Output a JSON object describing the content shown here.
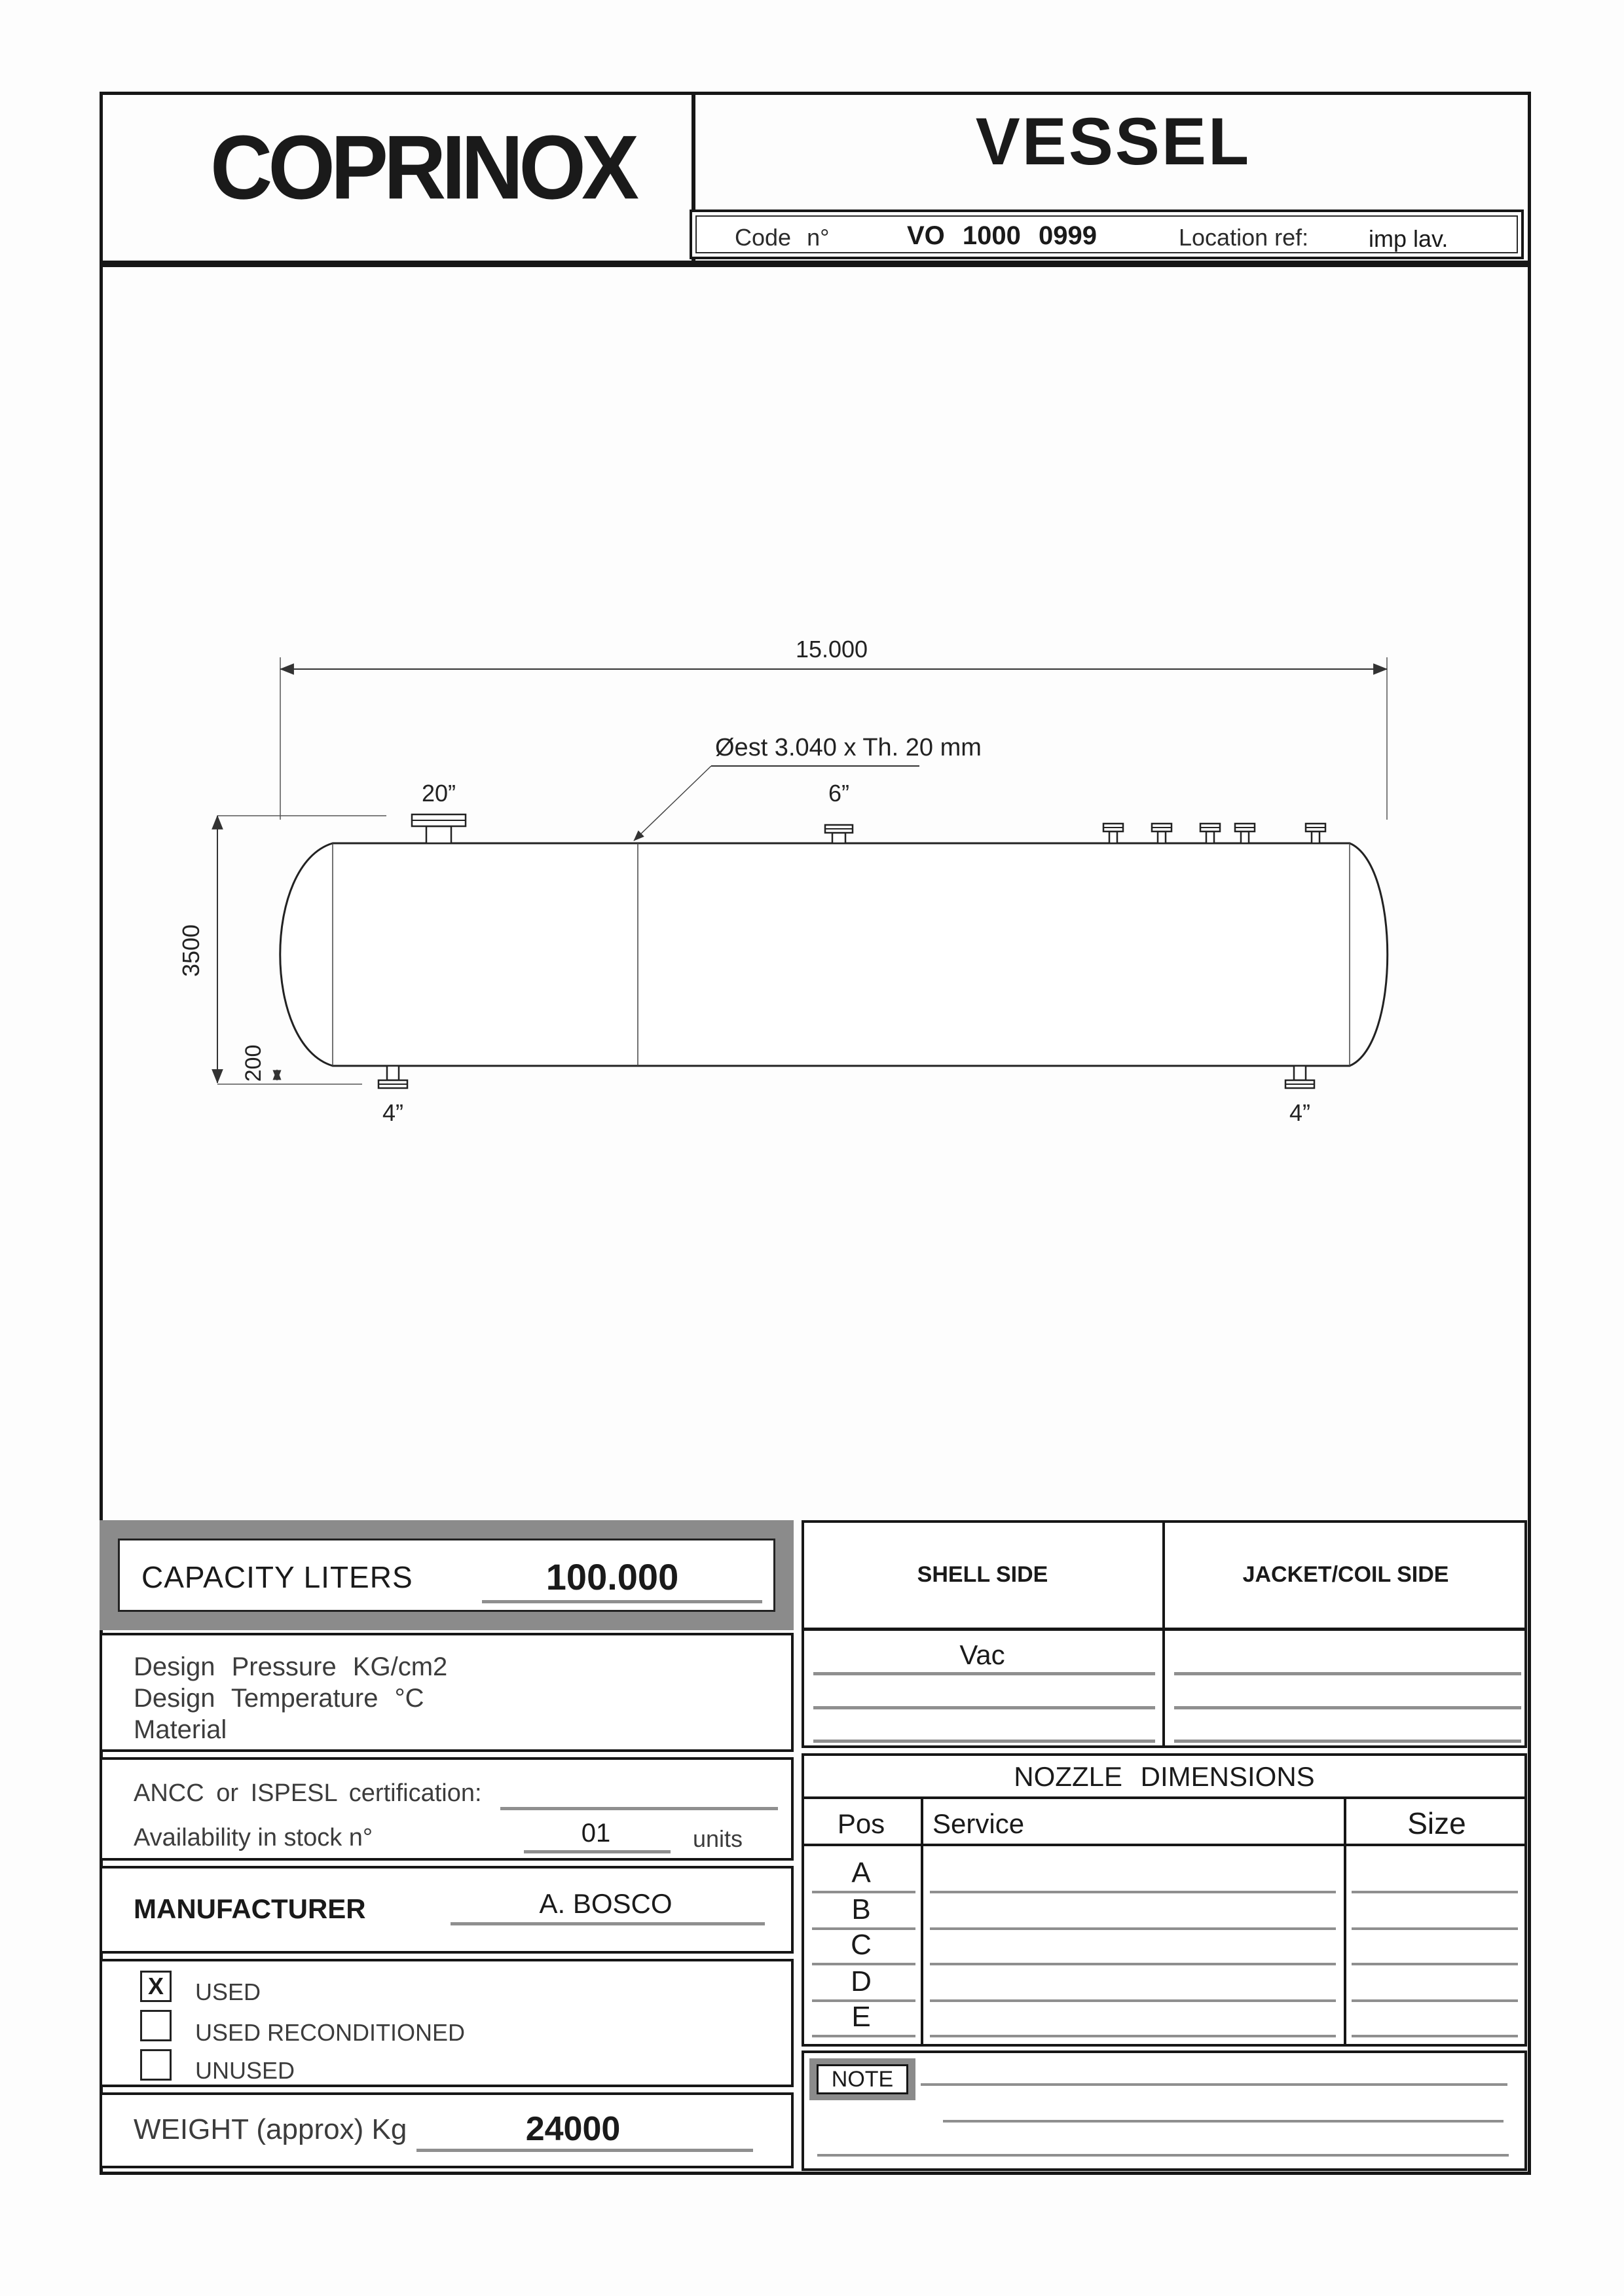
{
  "header": {
    "logo_text": "COPRINOX",
    "doc_title": "VESSEL",
    "code_label": "Code n°",
    "code_value": "VO 1000 0999",
    "location_label": "Location ref:",
    "location_value": "imp lav."
  },
  "drawing": {
    "overall_length": "15.000",
    "shell_note": "Øest 3.040 x Th. 20 mm",
    "top_nozzle_large": "20”",
    "top_nozzle_mid": "6”",
    "diameter": "3500",
    "clearance": "200",
    "bottom_nozzle_left": "4”",
    "bottom_nozzle_right": "4”"
  },
  "capacity": {
    "label": "CAPACITY LITERS",
    "value": "100.000"
  },
  "design": {
    "lines": [
      "Design Pressure KG/cm2",
      "Design Temperature °C",
      "Material"
    ]
  },
  "certification": {
    "ancc_label": "ANCC or ISPESL certification:",
    "stock_label": "Availability in stock n°",
    "stock_value": "01",
    "stock_units": "units"
  },
  "manufacturer": {
    "label": "MANUFACTURER",
    "value": "A. BOSCO"
  },
  "condition": {
    "used": {
      "label": "USED",
      "mark": "X"
    },
    "used_reconditioned": {
      "label": "USED RECONDITIONED",
      "mark": ""
    },
    "unused": {
      "label": "UNUSED",
      "mark": ""
    }
  },
  "weight": {
    "label": "WEIGHT (approx) Kg",
    "value": "24000"
  },
  "sides": {
    "shell_header": "SHELL SIDE",
    "jacket_header": "JACKET/COIL SIDE",
    "shell_row1": "Vac"
  },
  "nozzles": {
    "title": "NOZZLE DIMENSIONS",
    "col_pos": "Pos",
    "col_service": "Service",
    "col_size": "Size",
    "rows": [
      {
        "pos": "A"
      },
      {
        "pos": "B"
      },
      {
        "pos": "C"
      },
      {
        "pos": "D"
      },
      {
        "pos": "E"
      }
    ]
  },
  "note": {
    "label": "NOTE"
  },
  "colors": {
    "band_gray": "#8b8b8b",
    "rule_gray": "#8f8f8f",
    "ink": "#161616"
  }
}
